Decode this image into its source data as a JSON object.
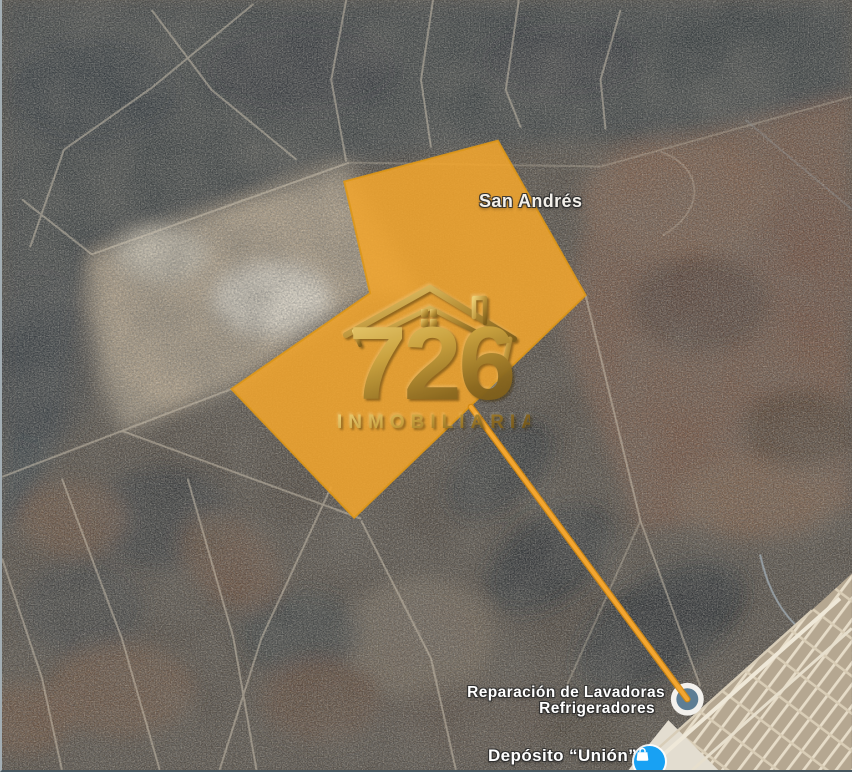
{
  "map": {
    "place_labels": {
      "san_andres": "San Andrés",
      "business_line1": "Reparación de Lavadoras",
      "business_line2": "Refrigeradores",
      "deposito": "Depósito “Unión”"
    },
    "watermark": {
      "number": "726",
      "subtitle": "INMOBILIARIA"
    },
    "overlay": {
      "parcel": {
        "points": "343,182 497,141 585,296 353,519 230,390 369,294"
      },
      "connector": {
        "path": "M470,408 L687,701"
      },
      "marker": {
        "transform": "translate(687,701)"
      }
    },
    "icons": {
      "poi": "shopping-bag-icon",
      "marker": "line-endpoint-circle-marker",
      "logo": "house-roof-icon"
    }
  },
  "colors": {
    "parcel-orange": "#F2A52D",
    "parcel-border": "#DD9718",
    "connector-orange": "#F3A630",
    "connector-edge": "#D4880E",
    "marker-ring": "#F3F1ED",
    "marker-fill": "#5D7D94",
    "poi-blue": "#18A1F3",
    "label-white": "#FFFFFF",
    "logo-gold-light": "#ECD077",
    "logo-gold-dark": "#6B4F13"
  }
}
